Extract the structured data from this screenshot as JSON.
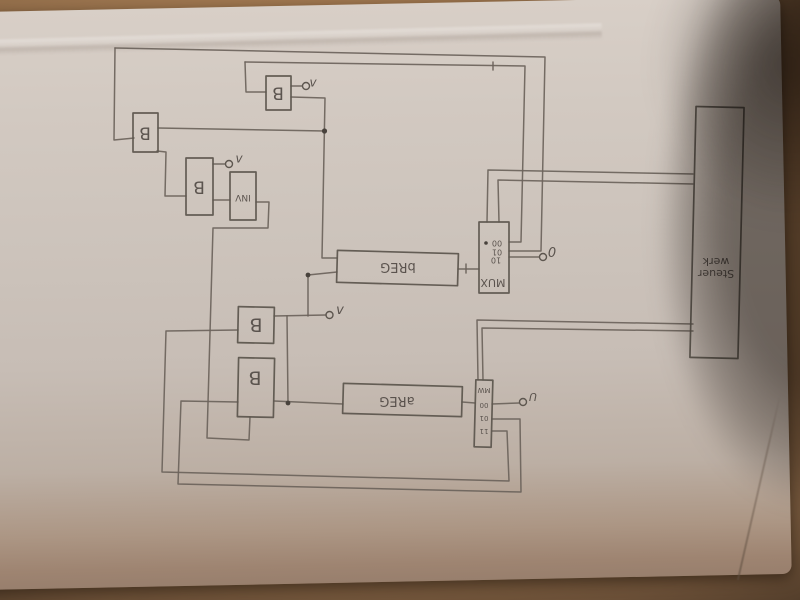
{
  "diagram": {
    "labels": {
      "b1": "B",
      "b2": "B",
      "b3": "B",
      "b4": "B",
      "b5": "B",
      "inv": "INV",
      "breg": "bREG",
      "areg": "aREG",
      "mux": "MUX",
      "mux_ports": [
        "00",
        "01",
        "10"
      ],
      "mux_select": "0",
      "amux_rows": [
        "MW",
        "00",
        "01",
        "11"
      ],
      "amux_select": "U",
      "steuerwerk_line1": "Steuer",
      "steuerwerk_line2": "werk",
      "t1": "v",
      "t2": "v",
      "t3": "v"
    },
    "colors": {
      "paper": "#cdc4bc",
      "table": "#9a734e",
      "pencil": "#665f58",
      "shadow": "#3a322c"
    }
  }
}
